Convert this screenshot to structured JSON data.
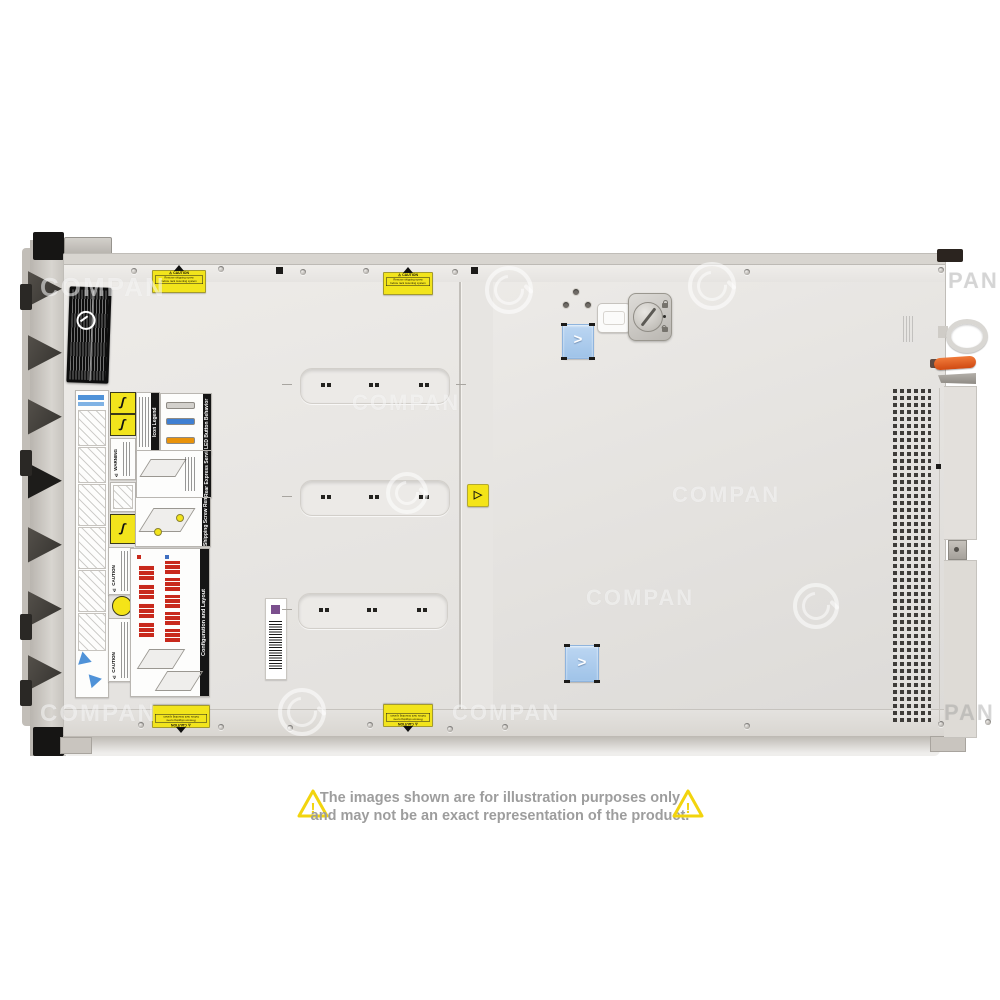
{
  "watermark": {
    "text": "COMPAN",
    "fragment": "PAN"
  },
  "caution_sticker": {
    "title": "⚠ CAUTION",
    "line1": "Remove shipping screw",
    "line2": "before rack mounting system"
  },
  "mini_labels": {
    "icon_legend": "Icon Legend",
    "led_button_behavior": "LED Button Behavior",
    "rear_express_service_tag": "Rear Express Service Tag",
    "shipping_screw_removal": "Shipping Screw Removal",
    "configuration_and_layout": "Configuration and Layout",
    "warning": "⚠ WARNING",
    "caution": "⚠ CAUTION"
  },
  "disclaimer": {
    "line1": "The images shown are for illustration purposes only",
    "line2": "and may not be an exact representation of the product."
  },
  "colors": {
    "background": "#ffffff",
    "chassis_gray": "#e7e5e2",
    "sticker_yellow": "#f2e41c",
    "latch_blue": "#aecdee",
    "lever_orange": "#e0581e",
    "led_blue": "#3f7fd2",
    "led_orange": "#e8920a",
    "drive_bay_red": "#c8291c",
    "disclaimer_text": "#9d9d9d",
    "triangle_yellow": "#f2d40e"
  }
}
